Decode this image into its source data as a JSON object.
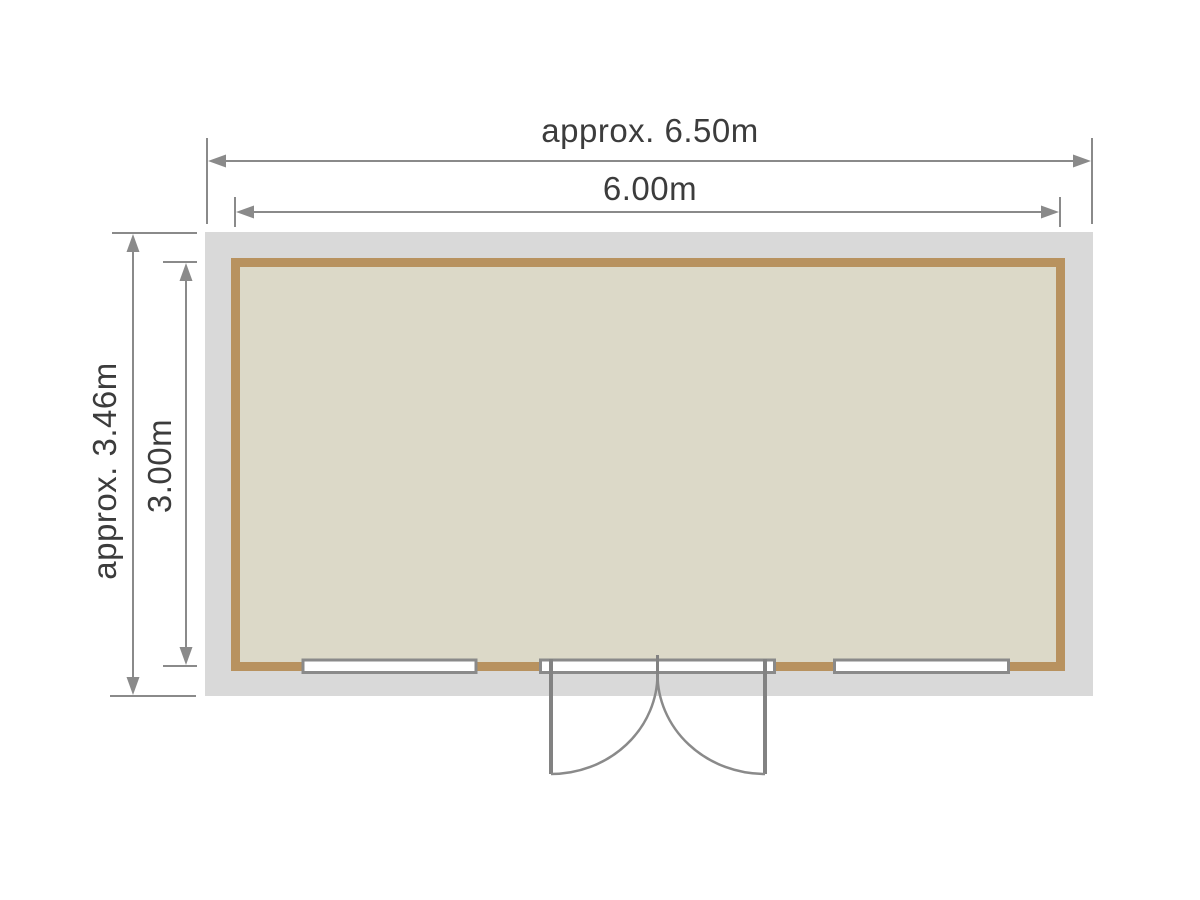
{
  "floor_plan": {
    "title": "shed-floor-plan",
    "labels": {
      "outer_width": "approx. 6.50m",
      "inner_width": "6.00m",
      "outer_depth": "approx. 3.46m",
      "inner_depth": "3.00m"
    },
    "colors": {
      "background": "#ffffff",
      "roof_overhang": "#d9d9d9",
      "wall": "#b8925f",
      "floor": "#dcd9c8",
      "dimension_line": "#8a8a8a",
      "door_line": "#828282",
      "opening_fill": "#ffffff",
      "text": "#3c3c3c"
    },
    "elements": {
      "window_count": 2,
      "door_type": "double-door",
      "door_position": "bottom-center"
    }
  }
}
